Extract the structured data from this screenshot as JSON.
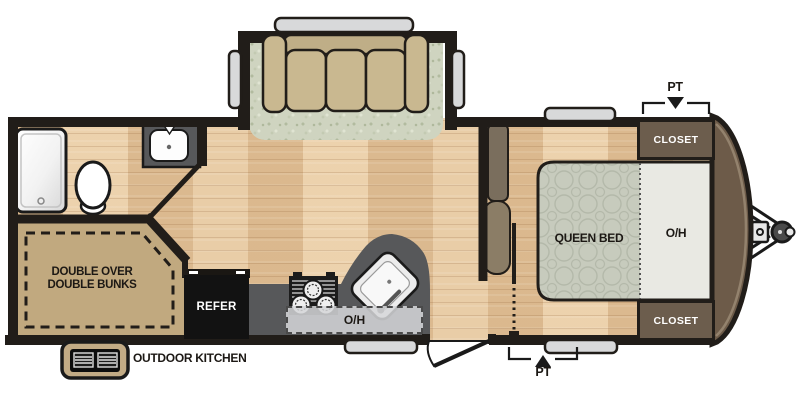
{
  "floorplan": {
    "bedroom": {
      "bed_label": "QUEEN BED",
      "overhead_label": "O/H",
      "closet_top_label": "CLOSET",
      "closet_bottom_label": "CLOSET",
      "pass_through_top_label": "PT",
      "pass_through_bottom_label": "PT"
    },
    "kitchen": {
      "refrigerator_label": "REFER",
      "overhead_label": "O/H"
    },
    "bunk_room": {
      "label_line1": "DOUBLE OVER",
      "label_line2": "DOUBLE BUNKS"
    },
    "exterior": {
      "outdoor_kitchen_label": "OUTDOOR KITCHEN"
    },
    "colors": {
      "wall": "#211d19",
      "wood_floor": "#e9cda7",
      "carpet": "#cfd4c0",
      "counter_gray": "#57585a",
      "closet_brown": "#6c5d4d",
      "bunk_tan": "#c1a97f",
      "bed_quilt": "#c7cbbd",
      "overhead_light": "#e9e9e3",
      "front_cap_brown": "#6d5b49",
      "sofa_tan": "#c9b890",
      "window_gray": "#d8d9da"
    }
  }
}
